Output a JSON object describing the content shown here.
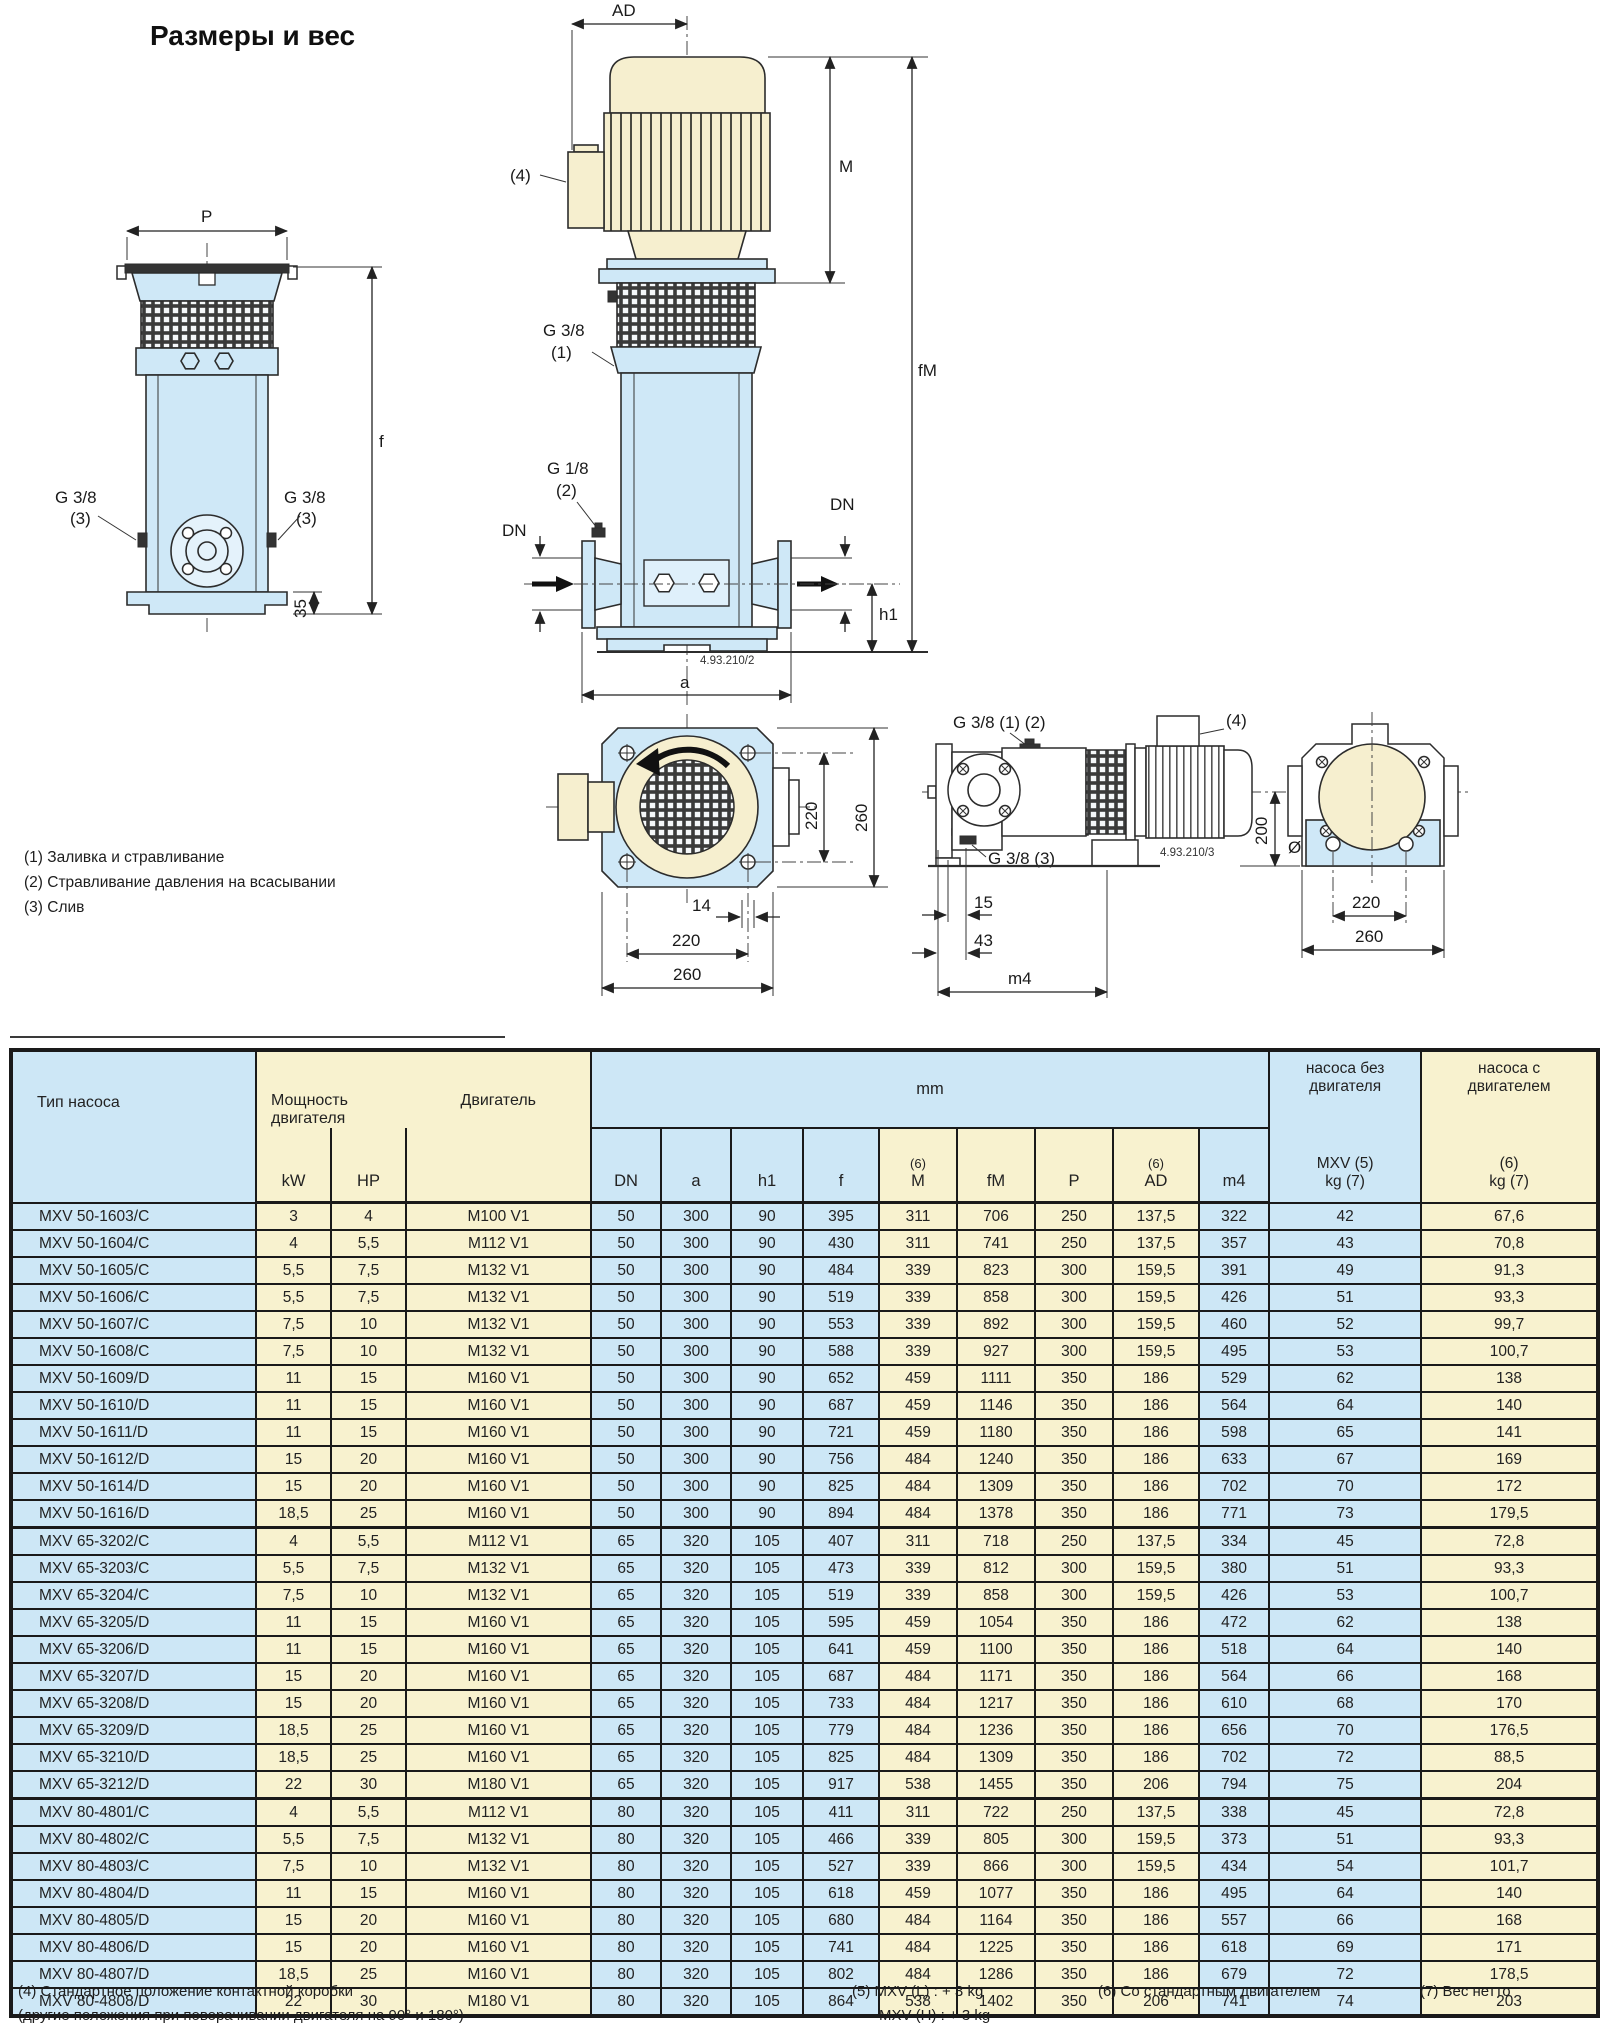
{
  "page": {
    "title": "Размеры и вес"
  },
  "colors": {
    "blue": "#cde7f6",
    "cream": "#f8f2cf",
    "line": "#1a1a1a"
  },
  "drawings": {
    "front_code": "4.93.210/2",
    "side_code": "4.93.210/3",
    "notes": [
      "(1) Заливка и стравливание",
      "(2) Стравливание давления на всасывании",
      "(3) Слив"
    ],
    "labels": {
      "P": "P",
      "f": "f",
      "AD": "AD",
      "M": "M",
      "fM": "fM",
      "DN": "DN",
      "h1": "h1",
      "a": "a",
      "m4": "m4",
      "g38": "G 3/8",
      "g18": "G 1/8",
      "ref1": "(1)",
      "ref2": "(2)",
      "ref3": "(3)",
      "ref4": "(4)",
      "g38_12": "G 3/8 (1) (2)",
      "g38_3": "G 3/8 (3)",
      "d35": "35",
      "d200": "200",
      "d15": "15",
      "d43": "43",
      "d14": "14",
      "dia14": "Ø14",
      "d220": "220",
      "d260": "260"
    }
  },
  "table": {
    "header": {
      "pump_type": "Тип насоса",
      "power_l1": "Мощность",
      "power_l2": "двигателя",
      "motor": "Двигатель",
      "kw": "kW",
      "hp": "HP",
      "mm": "mm",
      "sup6": "(6)",
      "dn": "DN",
      "a": "a",
      "h1": "h1",
      "f": "f",
      "m": "M",
      "fm": "fM",
      "p": "P",
      "ad": "AD",
      "m4": "m4",
      "wo_l1": "насоса без",
      "wo_l2": "двигателя",
      "wo_l3": "MXV (5)",
      "wo_l4": "kg (7)",
      "w_l1": "насоса с",
      "w_l2": "двигателем",
      "w_l3": "(6)",
      "w_l4": "kg (7)"
    },
    "groups": [
      {
        "rows": [
          [
            "MXV 50-1603/C",
            "3",
            "4",
            "M100 V1",
            "50",
            "300",
            "90",
            "395",
            "311",
            "706",
            "250",
            "137,5",
            "322",
            "42",
            "67,6"
          ],
          [
            "MXV 50-1604/C",
            "4",
            "5,5",
            "M112 V1",
            "50",
            "300",
            "90",
            "430",
            "311",
            "741",
            "250",
            "137,5",
            "357",
            "43",
            "70,8"
          ],
          [
            "MXV 50-1605/C",
            "5,5",
            "7,5",
            "M132 V1",
            "50",
            "300",
            "90",
            "484",
            "339",
            "823",
            "300",
            "159,5",
            "391",
            "49",
            "91,3"
          ],
          [
            "MXV 50-1606/C",
            "5,5",
            "7,5",
            "M132 V1",
            "50",
            "300",
            "90",
            "519",
            "339",
            "858",
            "300",
            "159,5",
            "426",
            "51",
            "93,3"
          ],
          [
            "MXV 50-1607/C",
            "7,5",
            "10",
            "M132 V1",
            "50",
            "300",
            "90",
            "553",
            "339",
            "892",
            "300",
            "159,5",
            "460",
            "52",
            "99,7"
          ],
          [
            "MXV 50-1608/C",
            "7,5",
            "10",
            "M132 V1",
            "50",
            "300",
            "90",
            "588",
            "339",
            "927",
            "300",
            "159,5",
            "495",
            "53",
            "100,7"
          ],
          [
            "MXV 50-1609/D",
            "11",
            "15",
            "M160 V1",
            "50",
            "300",
            "90",
            "652",
            "459",
            "1111",
            "350",
            "186",
            "529",
            "62",
            "138"
          ],
          [
            "MXV 50-1610/D",
            "11",
            "15",
            "M160 V1",
            "50",
            "300",
            "90",
            "687",
            "459",
            "1146",
            "350",
            "186",
            "564",
            "64",
            "140"
          ],
          [
            "MXV 50-1611/D",
            "11",
            "15",
            "M160 V1",
            "50",
            "300",
            "90",
            "721",
            "459",
            "1180",
            "350",
            "186",
            "598",
            "65",
            "141"
          ],
          [
            "MXV 50-1612/D",
            "15",
            "20",
            "M160 V1",
            "50",
            "300",
            "90",
            "756",
            "484",
            "1240",
            "350",
            "186",
            "633",
            "67",
            "169"
          ],
          [
            "MXV 50-1614/D",
            "15",
            "20",
            "M160 V1",
            "50",
            "300",
            "90",
            "825",
            "484",
            "1309",
            "350",
            "186",
            "702",
            "70",
            "172"
          ],
          [
            "MXV 50-1616/D",
            "18,5",
            "25",
            "M160 V1",
            "50",
            "300",
            "90",
            "894",
            "484",
            "1378",
            "350",
            "186",
            "771",
            "73",
            "179,5"
          ]
        ]
      },
      {
        "rows": [
          [
            "MXV 65-3202/C",
            "4",
            "5,5",
            "M112 V1",
            "65",
            "320",
            "105",
            "407",
            "311",
            "718",
            "250",
            "137,5",
            "334",
            "45",
            "72,8"
          ],
          [
            "MXV 65-3203/C",
            "5,5",
            "7,5",
            "M132 V1",
            "65",
            "320",
            "105",
            "473",
            "339",
            "812",
            "300",
            "159,5",
            "380",
            "51",
            "93,3"
          ],
          [
            "MXV 65-3204/C",
            "7,5",
            "10",
            "M132 V1",
            "65",
            "320",
            "105",
            "519",
            "339",
            "858",
            "300",
            "159,5",
            "426",
            "53",
            "100,7"
          ],
          [
            "MXV 65-3205/D",
            "11",
            "15",
            "M160 V1",
            "65",
            "320",
            "105",
            "595",
            "459",
            "1054",
            "350",
            "186",
            "472",
            "62",
            "138"
          ],
          [
            "MXV 65-3206/D",
            "11",
            "15",
            "M160 V1",
            "65",
            "320",
            "105",
            "641",
            "459",
            "1100",
            "350",
            "186",
            "518",
            "64",
            "140"
          ],
          [
            "MXV 65-3207/D",
            "15",
            "20",
            "M160 V1",
            "65",
            "320",
            "105",
            "687",
            "484",
            "1171",
            "350",
            "186",
            "564",
            "66",
            "168"
          ],
          [
            "MXV 65-3208/D",
            "15",
            "20",
            "M160 V1",
            "65",
            "320",
            "105",
            "733",
            "484",
            "1217",
            "350",
            "186",
            "610",
            "68",
            "170"
          ],
          [
            "MXV 65-3209/D",
            "18,5",
            "25",
            "M160 V1",
            "65",
            "320",
            "105",
            "779",
            "484",
            "1236",
            "350",
            "186",
            "656",
            "70",
            "176,5"
          ],
          [
            "MXV 65-3210/D",
            "18,5",
            "25",
            "M160 V1",
            "65",
            "320",
            "105",
            "825",
            "484",
            "1309",
            "350",
            "186",
            "702",
            "72",
            "88,5"
          ],
          [
            "MXV 65-3212/D",
            "22",
            "30",
            "M180 V1",
            "65",
            "320",
            "105",
            "917",
            "538",
            "1455",
            "350",
            "206",
            "794",
            "75",
            "204"
          ]
        ]
      },
      {
        "rows": [
          [
            "MXV 80-4801/C",
            "4",
            "5,5",
            "M112 V1",
            "80",
            "320",
            "105",
            "411",
            "311",
            "722",
            "250",
            "137,5",
            "338",
            "45",
            "72,8"
          ],
          [
            "MXV 80-4802/C",
            "5,5",
            "7,5",
            "M132 V1",
            "80",
            "320",
            "105",
            "466",
            "339",
            "805",
            "300",
            "159,5",
            "373",
            "51",
            "93,3"
          ],
          [
            "MXV 80-4803/C",
            "7,5",
            "10",
            "M132 V1",
            "80",
            "320",
            "105",
            "527",
            "339",
            "866",
            "300",
            "159,5",
            "434",
            "54",
            "101,7"
          ],
          [
            "MXV 80-4804/D",
            "11",
            "15",
            "M160 V1",
            "80",
            "320",
            "105",
            "618",
            "459",
            "1077",
            "350",
            "186",
            "495",
            "64",
            "140"
          ],
          [
            "MXV 80-4805/D",
            "15",
            "20",
            "M160 V1",
            "80",
            "320",
            "105",
            "680",
            "484",
            "1164",
            "350",
            "186",
            "557",
            "66",
            "168"
          ],
          [
            "MXV 80-4806/D",
            "15",
            "20",
            "M160 V1",
            "80",
            "320",
            "105",
            "741",
            "484",
            "1225",
            "350",
            "186",
            "618",
            "69",
            "171"
          ],
          [
            "MXV 80-4807/D",
            "18,5",
            "25",
            "M160 V1",
            "80",
            "320",
            "105",
            "802",
            "484",
            "1286",
            "350",
            "186",
            "679",
            "72",
            "178,5"
          ],
          [
            "MXV 80-4808/D",
            "22",
            "30",
            "M180 V1",
            "80",
            "320",
            "105",
            "864",
            "538",
            "1402",
            "350",
            "206",
            "741",
            "74",
            "203"
          ]
        ]
      }
    ]
  },
  "footnotes": {
    "f4_l1": "(4) Стандартное положение контактной коробки",
    "f4_l2": "(другие положения при поворачивании двигателя на 90° и 180°)",
    "f5_l1": "(5) MXV (L) : + 3 kg",
    "f5_l2": "MXV (H) : + 3 kg",
    "f6": "(6) Со стандартным двигателем",
    "f7": "(7) Вес нетто"
  }
}
